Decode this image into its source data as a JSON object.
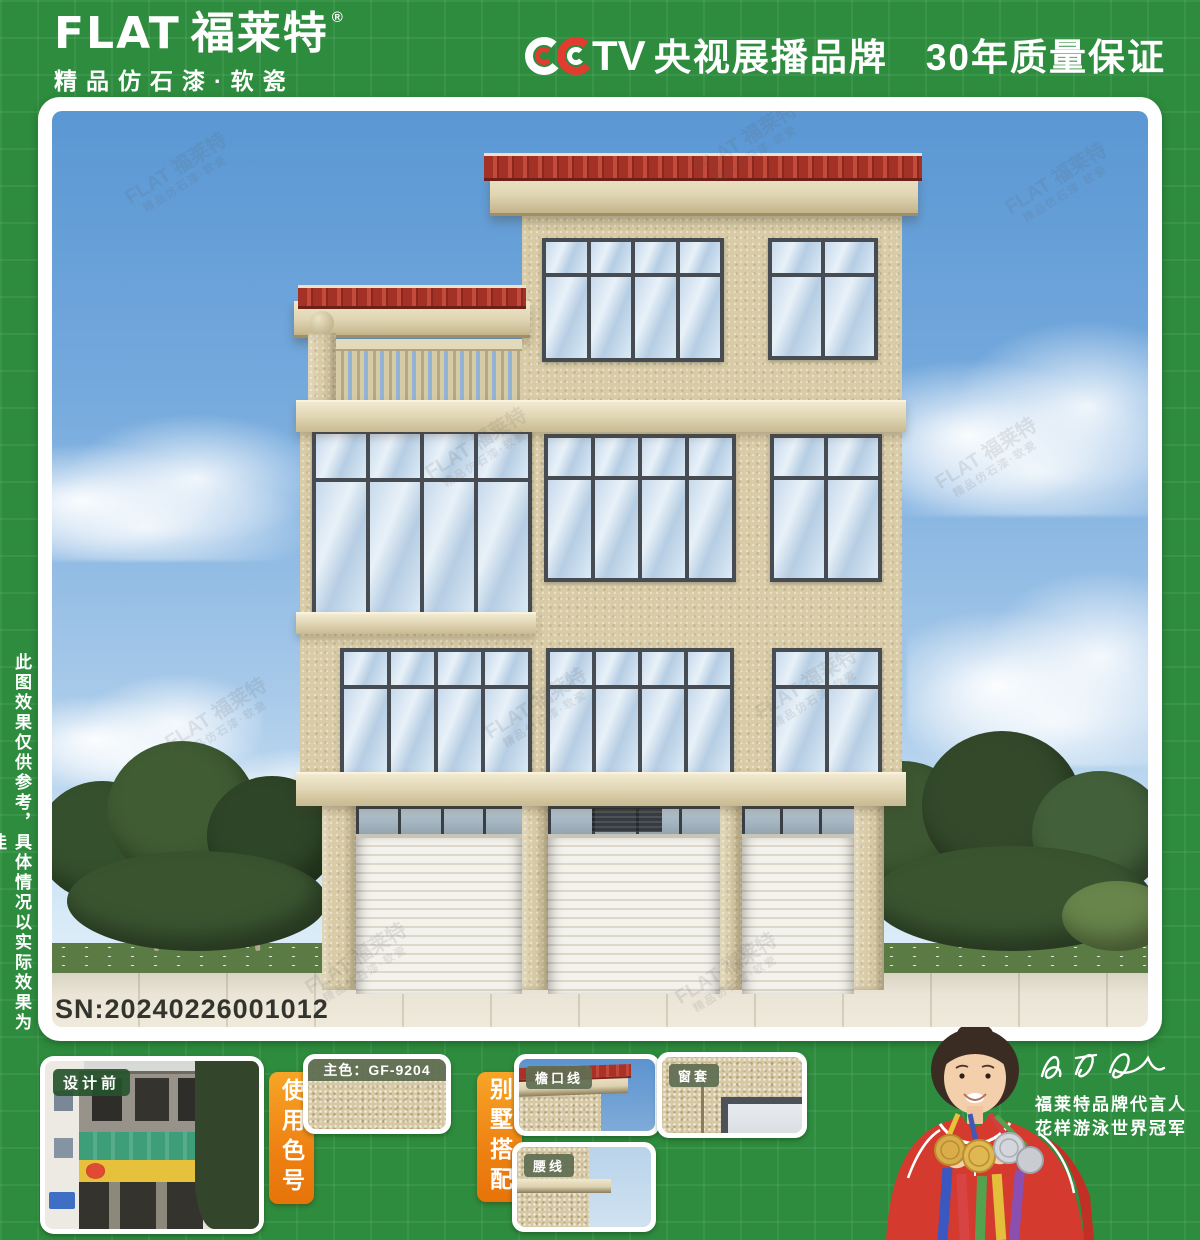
{
  "brand": {
    "name": "FLAT",
    "name_cn": "福莱特",
    "reg": "®",
    "tagline": "精品仿石漆·软瓷"
  },
  "header": {
    "cctv": "CCTV",
    "cctv_brand": "央视展播品牌",
    "guarantee": "30年质量保证"
  },
  "side_note": "此图效果仅供参考，具体情况以实际效果为佳",
  "render": {
    "sn": "SN:20240226001012",
    "watermark": "FLAT 福莱特",
    "watermark_sub": "精品仿石漆·软瓷"
  },
  "bottom": {
    "before_label": "设计前",
    "use_color_tab": "使用色号",
    "main_color": "主色：GF-9204",
    "villa_match_tab": "别墅搭配",
    "swatch_eave": "檐口线",
    "swatch_waist": "腰线",
    "swatch_window": "窗套"
  },
  "spokesperson": {
    "line1": "福莱特品牌代言人",
    "line2": "花样游泳世界冠军"
  },
  "colors": {
    "frame_green": "#2e8c3e",
    "accent_orange": "#ee8112",
    "wall_beige": "#d8cba5",
    "roof_red": "#a33126",
    "sky_top": "#5a97d3",
    "label_olive": "#606e52",
    "cctv_red": "#e23b30"
  }
}
